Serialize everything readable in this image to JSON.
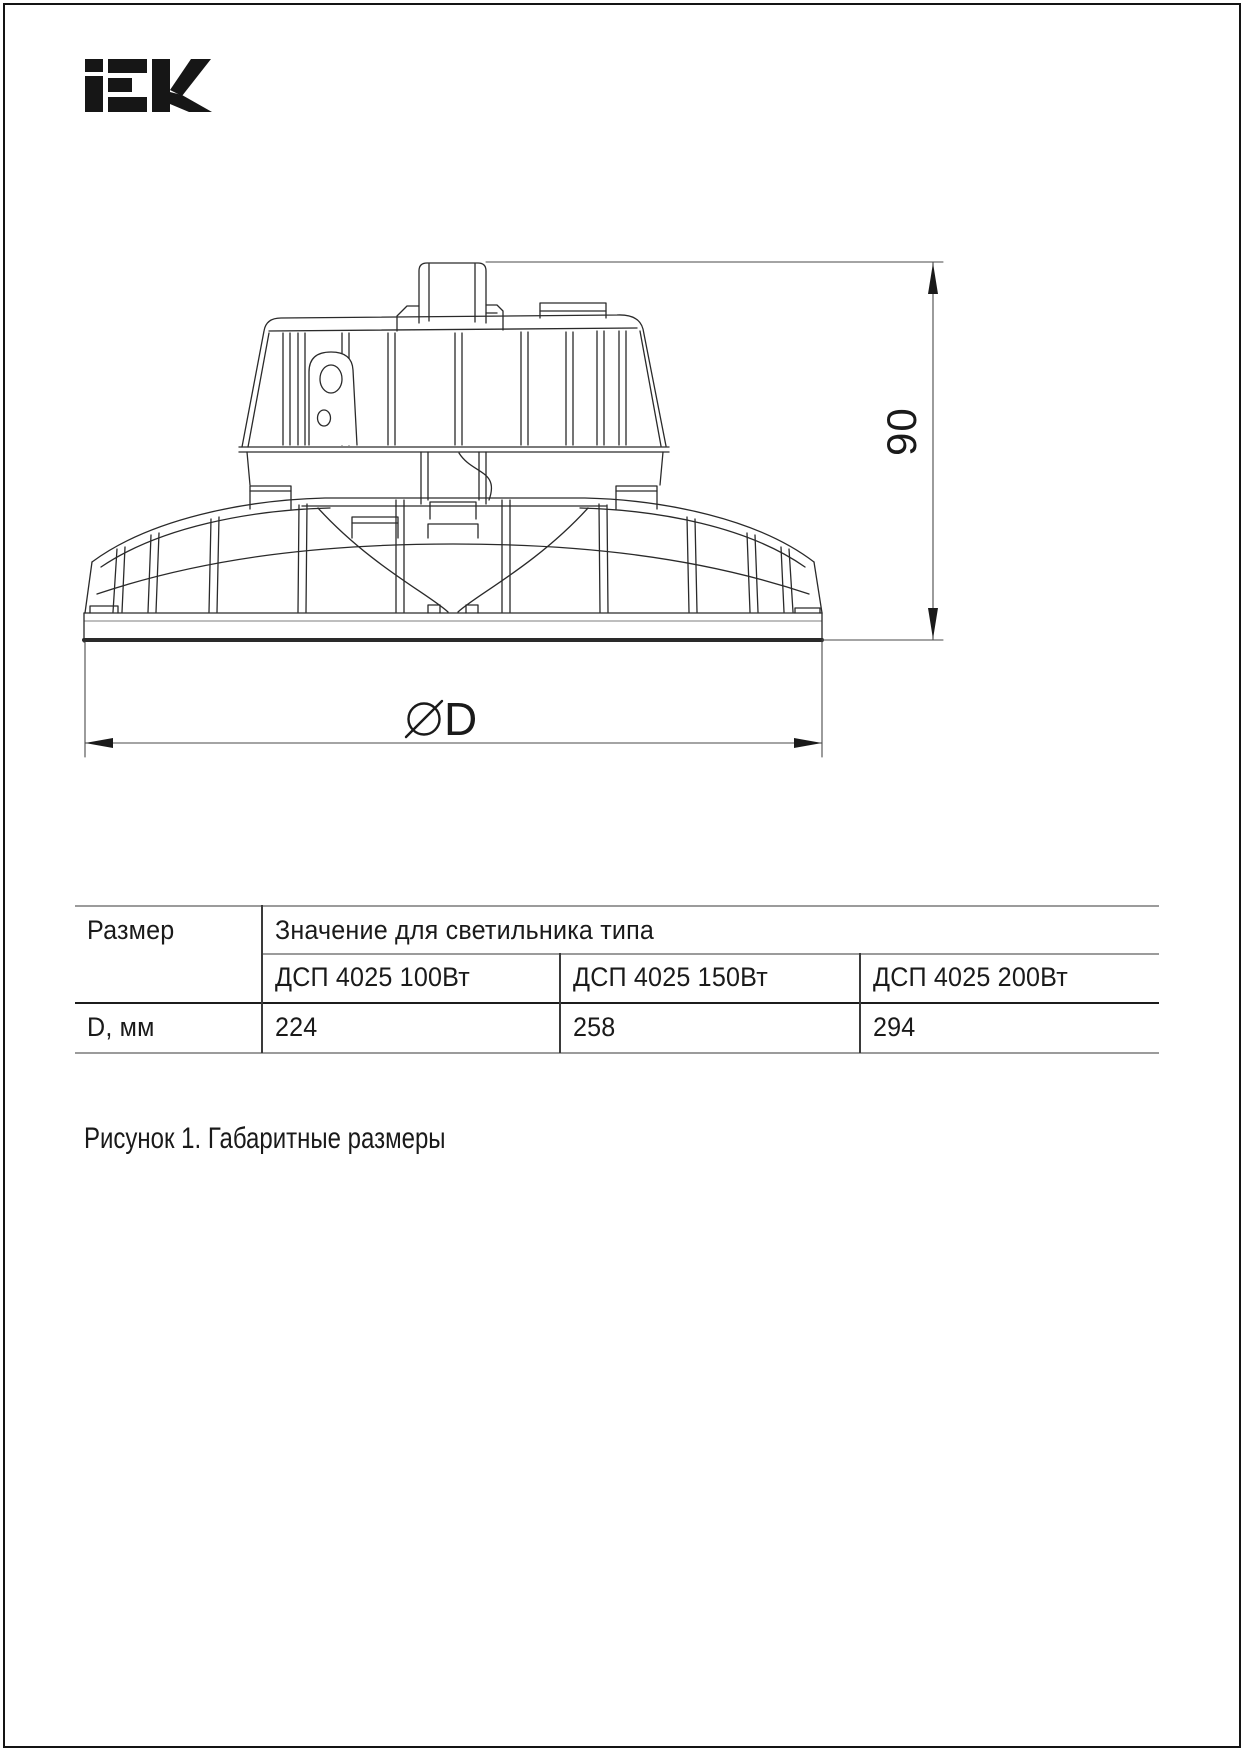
{
  "logo": {
    "brand": "IEK"
  },
  "drawing": {
    "height_dimension": {
      "value": "90"
    },
    "diameter_dimension": {
      "value": "D"
    },
    "caption": "Рисунок 1. Габаритные размеры"
  },
  "table": {
    "header_col": "Размер",
    "header_span": "Значение для светильника типа",
    "columns": [
      "ДСП 4025 100Вт",
      "ДСП 4025 150Вт",
      "ДСП 4025 200Вт"
    ],
    "rows": [
      {
        "label": "D, мм",
        "values": [
          "224",
          "258",
          "294"
        ]
      }
    ]
  }
}
